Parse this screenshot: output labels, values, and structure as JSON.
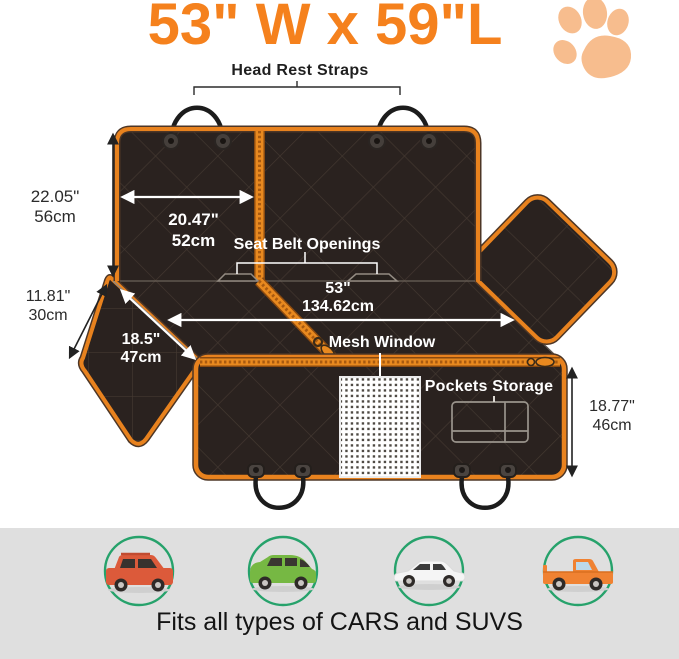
{
  "title": "53\" W x 59\"L",
  "labels": {
    "head_rest_straps": "Head Rest Straps",
    "seat_belt_openings": "Seat Belt Openings",
    "mesh_window": "Mesh Window",
    "pockets_storage": "Pockets Storage"
  },
  "measurements": {
    "back_height": {
      "in": "22.05\"",
      "cm": "56cm"
    },
    "back_panel_width": {
      "in": "20.47\"",
      "cm": "52cm"
    },
    "side_flap_depth": {
      "in": "11.81\"",
      "cm": "30cm"
    },
    "side_flap_width": {
      "in": "18.5\"",
      "cm": "47cm"
    },
    "seat_width": {
      "in": "53\"",
      "cm": "134.62cm"
    },
    "front_height": {
      "in": "18.77\"",
      "cm": "46cm"
    }
  },
  "footer": {
    "caption": "Fits all types of CARS and SUVS",
    "vehicles": [
      "red suv",
      "green minivan",
      "white sedan",
      "orange pickup truck"
    ]
  },
  "icons": {
    "paw": "paw-print-icon"
  },
  "colors": {
    "accent_orange": "#F5811D",
    "trim_orange": "#E8821E",
    "fabric_black": "#2A221F",
    "paw_orange": "#F7BD8E",
    "footer_gray": "#DFDFDF",
    "circle_green": "#26A26B",
    "car_red": "#DC5A3A",
    "car_green": "#76B843",
    "car_white": "#F5F5F5",
    "car_orange": "#F08232"
  }
}
